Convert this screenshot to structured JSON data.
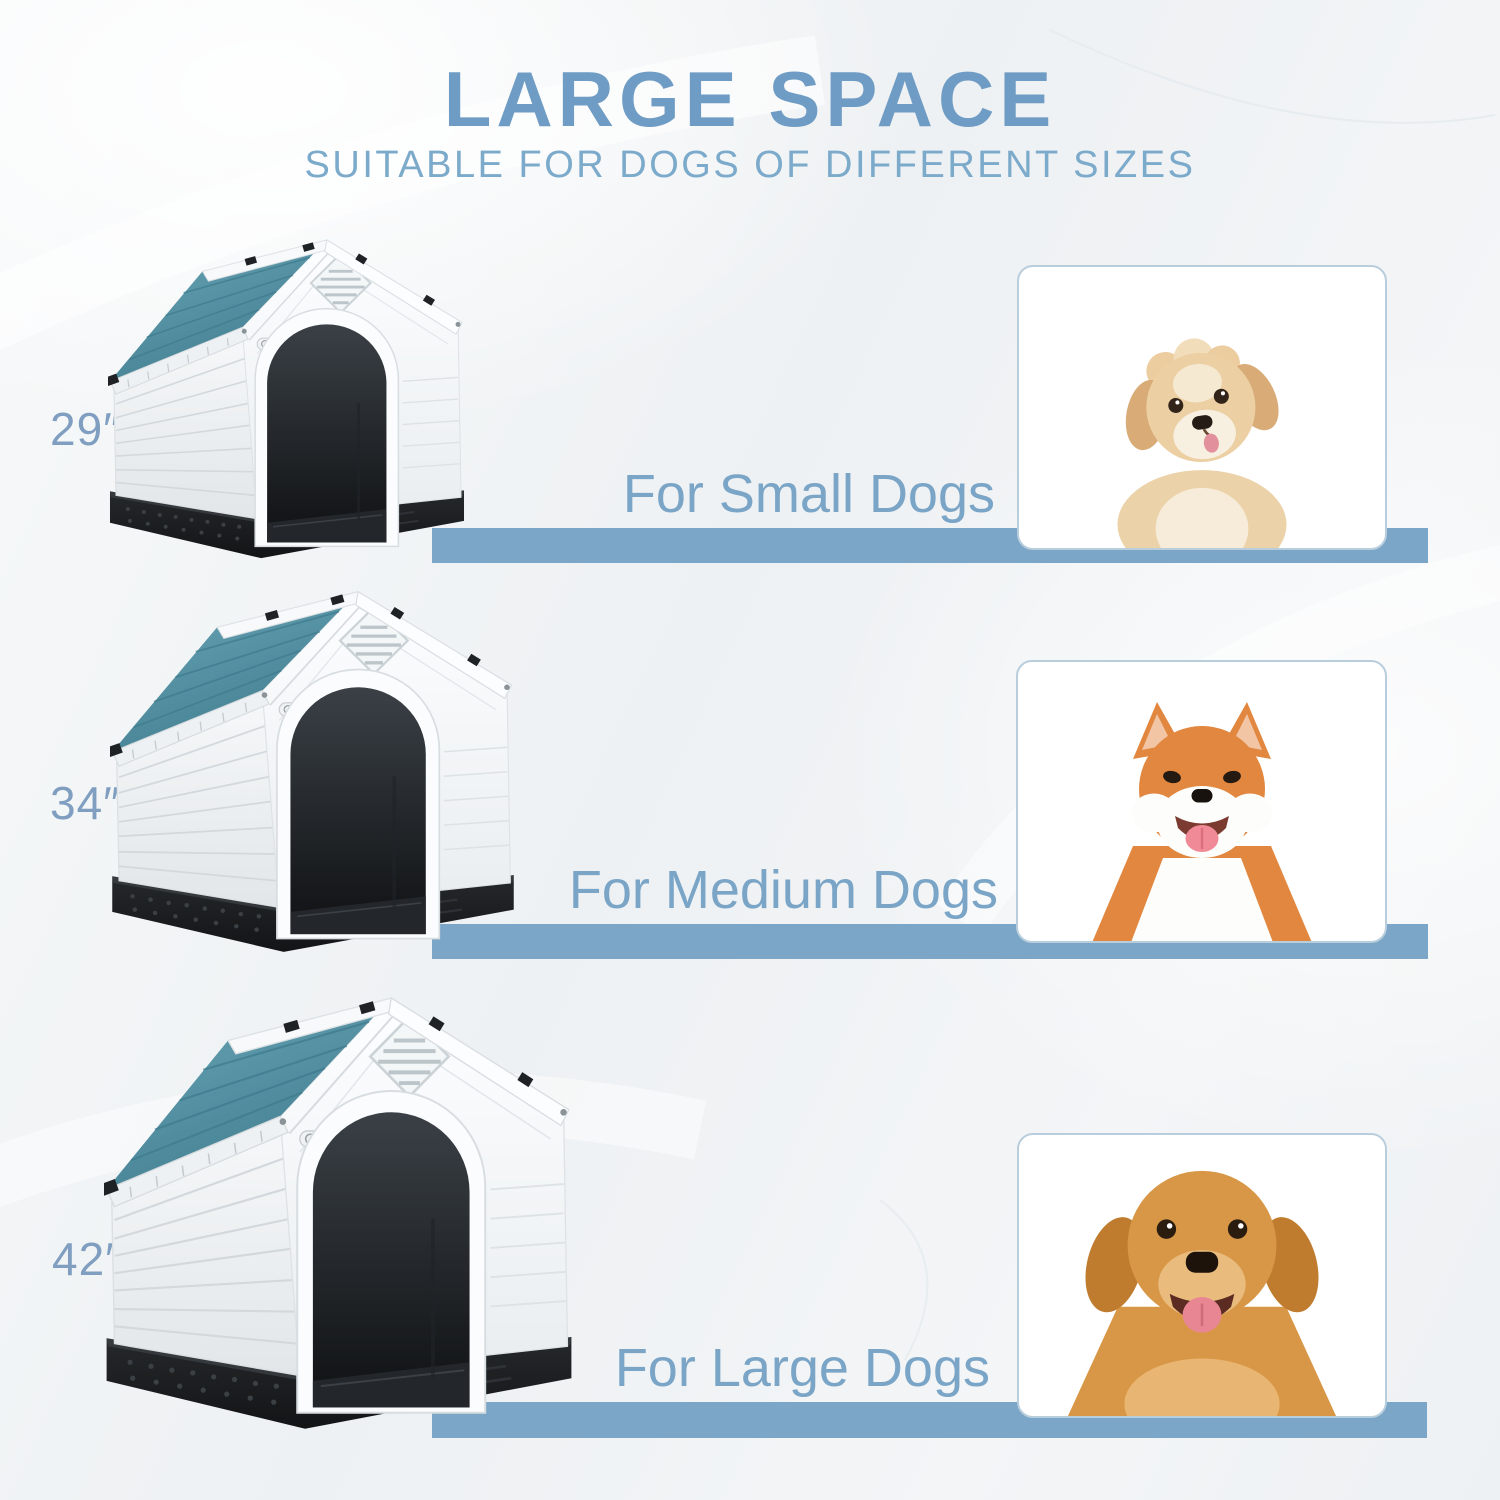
{
  "page": {
    "title": "LARGE SPACE",
    "subtitle": "SUITABLE FOR DOGS OF DIFFERENT SIZES"
  },
  "rows": [
    {
      "size_label": "29″",
      "caption": "For Small Dogs",
      "house_icon": "blue-roof-doghouse-29in",
      "dog_photo": "cream-fluffy-puppy"
    },
    {
      "size_label": "34″",
      "caption": "For Medium Dogs",
      "house_icon": "blue-roof-doghouse-34in",
      "dog_photo": "shiba-inu"
    },
    {
      "size_label": "42″",
      "caption": "For Large Dogs",
      "house_icon": "blue-roof-doghouse-42in",
      "dog_photo": "golden-retriever"
    }
  ],
  "colors": {
    "title_blue": "#6f9cc4",
    "subtitle_blue": "#7caacb",
    "bar_blue": "#7ba6c8",
    "caption_blue": "#7aa5c7",
    "size_label_blue": "#7f9ec0",
    "roof_teal": "#4f8a9e",
    "house_body_white": "#eef1f3",
    "house_base_black": "#1b1e20",
    "photo_frame_border": "#b9cedd"
  }
}
